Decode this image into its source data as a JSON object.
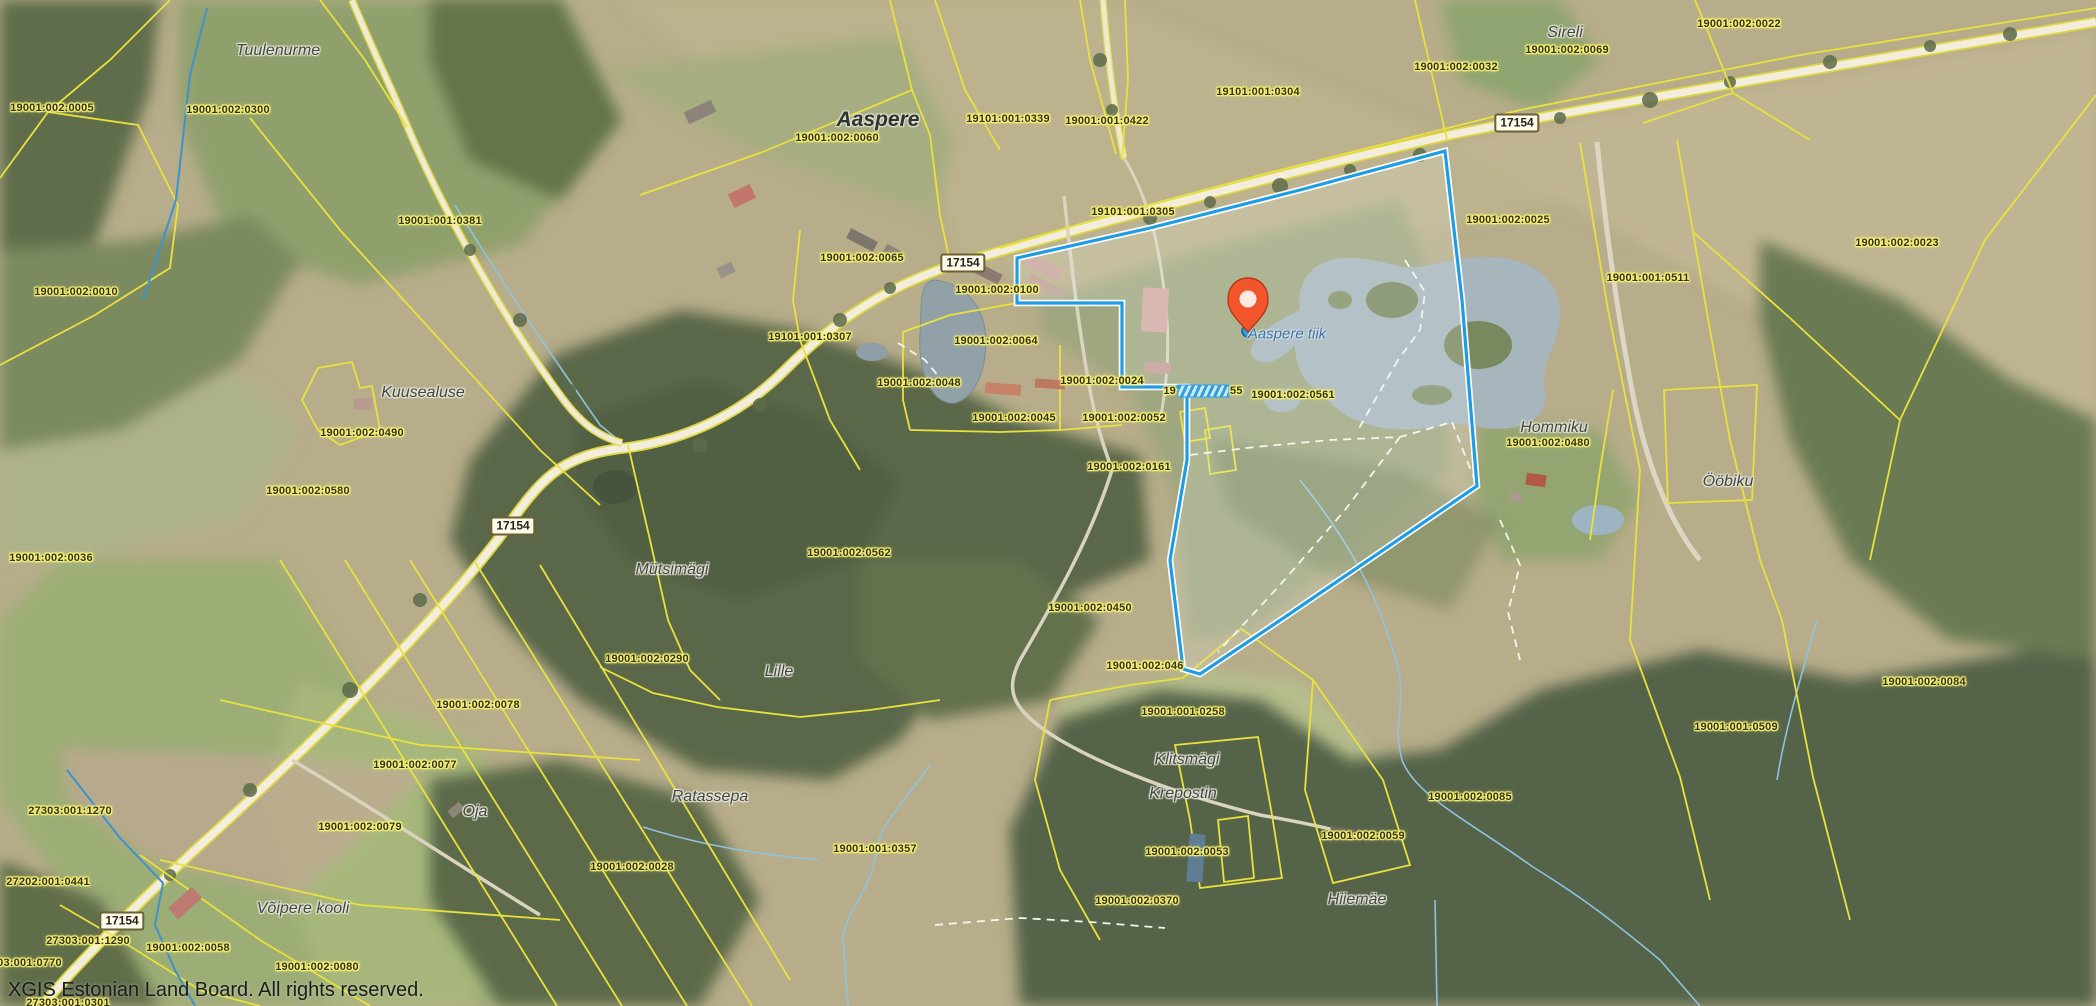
{
  "map": {
    "attribution": "XGIS Estonian Land Board. All rights reserved.",
    "colors": {
      "selection_blue": "#1f9ce2",
      "cadastral_yellow": "#e9e13d",
      "parcel_label_halo": "#f8f376",
      "marker_red": "#f2552c",
      "water_label_blue": "#3f72a6"
    },
    "marker": {
      "x": 1248,
      "y": 330,
      "snap_dot_color": "#2d9fe0"
    },
    "road_badges": [
      {
        "text": "17154",
        "x": 1517,
        "y": 123
      },
      {
        "text": "17154",
        "x": 963,
        "y": 263
      },
      {
        "text": "17154",
        "x": 513,
        "y": 526
      },
      {
        "text": "17154",
        "x": 122,
        "y": 921
      }
    ],
    "labels": [
      {
        "kind": "place",
        "text": "Tuulenurme",
        "x": 278,
        "y": 51
      },
      {
        "kind": "parcel",
        "text": "19001:002:0005",
        "x": 52,
        "y": 108
      },
      {
        "kind": "parcel",
        "text": "19001:002:0300",
        "x": 228,
        "y": 110
      },
      {
        "kind": "parcel",
        "text": "19001:001:0381",
        "x": 440,
        "y": 221
      },
      {
        "kind": "parcel",
        "text": "19001:002:0010",
        "x": 76,
        "y": 292
      },
      {
        "kind": "place",
        "text": "Kuusealuse",
        "x": 423,
        "y": 393
      },
      {
        "kind": "parcel",
        "text": "19001:002:0490",
        "x": 362,
        "y": 433
      },
      {
        "kind": "parcel",
        "text": "19001:002:0580",
        "x": 308,
        "y": 491
      },
      {
        "kind": "parcel",
        "text": "19001:002:0036",
        "x": 51,
        "y": 558
      },
      {
        "kind": "place-major",
        "text": "Aaspere",
        "x": 878,
        "y": 120
      },
      {
        "kind": "parcel",
        "text": "19001:002:0060",
        "x": 837,
        "y": 138
      },
      {
        "kind": "parcel",
        "text": "19101:001:0339",
        "x": 1008,
        "y": 119
      },
      {
        "kind": "parcel",
        "text": "19001:001:0422",
        "x": 1107,
        "y": 121
      },
      {
        "kind": "parcel",
        "text": "19101:001:0305",
        "x": 1133,
        "y": 212
      },
      {
        "kind": "parcel",
        "text": "19101:001:0304",
        "x": 1258,
        "y": 92
      },
      {
        "kind": "place",
        "text": "Sireli",
        "x": 1565,
        "y": 33
      },
      {
        "kind": "parcel",
        "text": "19001:002:0069",
        "x": 1567,
        "y": 50
      },
      {
        "kind": "parcel",
        "text": "19001:002:0032",
        "x": 1456,
        "y": 67
      },
      {
        "kind": "parcel",
        "text": "19001:002:0022",
        "x": 1739,
        "y": 24
      },
      {
        "kind": "parcel",
        "text": "19001:002:0025",
        "x": 1508,
        "y": 220
      },
      {
        "kind": "parcel",
        "text": "19001:001:0511",
        "x": 1648,
        "y": 278
      },
      {
        "kind": "parcel",
        "text": "19001:002:0023",
        "x": 1897,
        "y": 243
      },
      {
        "kind": "parcel",
        "text": "19001:002:0065",
        "x": 862,
        "y": 258
      },
      {
        "kind": "parcel",
        "text": "19001:002:0100",
        "x": 997,
        "y": 290
      },
      {
        "kind": "parcel",
        "text": "19101:001:0307",
        "x": 810,
        "y": 337
      },
      {
        "kind": "parcel",
        "text": "19001:002:0064",
        "x": 996,
        "y": 341
      },
      {
        "kind": "parcel",
        "text": "19001:002:0048",
        "x": 919,
        "y": 383
      },
      {
        "kind": "parcel",
        "text": "19001:002:0024",
        "x": 1102,
        "y": 381
      },
      {
        "kind": "parcel",
        "text": "19001:002:0045",
        "x": 1014,
        "y": 418
      },
      {
        "kind": "parcel",
        "text": "19001:002:0052",
        "x": 1124,
        "y": 418
      },
      {
        "kind": "parcel",
        "text": "19001:002:0561",
        "x": 1293,
        "y": 395
      },
      {
        "kind": "parcel-obscured",
        "prefix": "19",
        "suffix": "55",
        "x": 1203,
        "y": 391
      },
      {
        "kind": "water",
        "text": "Aaspere tiik",
        "x": 1287,
        "y": 334
      },
      {
        "kind": "parcel",
        "text": "19001:002:0161",
        "x": 1129,
        "y": 467
      },
      {
        "kind": "parcel",
        "text": "19001:002:046",
        "x": 1145,
        "y": 666
      },
      {
        "kind": "parcel",
        "text": "19001:002:0450",
        "x": 1090,
        "y": 608
      },
      {
        "kind": "place",
        "text": "Mütsimägi",
        "x": 672,
        "y": 570
      },
      {
        "kind": "parcel",
        "text": "19001:002:0562",
        "x": 849,
        "y": 553
      },
      {
        "kind": "parcel",
        "text": "19001:002:0290",
        "x": 647,
        "y": 659
      },
      {
        "kind": "place",
        "text": "Lille",
        "x": 779,
        "y": 672
      },
      {
        "kind": "parcel",
        "text": "19001:002:0078",
        "x": 478,
        "y": 705
      },
      {
        "kind": "parcel",
        "text": "19001:002:0077",
        "x": 415,
        "y": 765
      },
      {
        "kind": "place",
        "text": "Oja",
        "x": 475,
        "y": 812
      },
      {
        "kind": "parcel",
        "text": "19001:002:0079",
        "x": 360,
        "y": 827
      },
      {
        "kind": "place",
        "text": "Ratassepa",
        "x": 710,
        "y": 797
      },
      {
        "kind": "parcel",
        "text": "19001:002:0028",
        "x": 632,
        "y": 867
      },
      {
        "kind": "parcel",
        "text": "19001:001:0357",
        "x": 875,
        "y": 849
      },
      {
        "kind": "parcel",
        "text": "27303:001:1270",
        "x": 70,
        "y": 811
      },
      {
        "kind": "parcel",
        "text": "27202:001:0441",
        "x": 48,
        "y": 882
      },
      {
        "kind": "parcel",
        "text": "27303:001:1290",
        "x": 88,
        "y": 941
      },
      {
        "kind": "parcel",
        "text": "27303:001:0770",
        "x": 20,
        "y": 963
      },
      {
        "kind": "parcel",
        "text": "19001:002:0058",
        "x": 188,
        "y": 948
      },
      {
        "kind": "place",
        "text": "Võipere kooli",
        "x": 303,
        "y": 909
      },
      {
        "kind": "parcel",
        "text": "19001:002:0080",
        "x": 317,
        "y": 967
      },
      {
        "kind": "parcel",
        "text": "27303:001:0301",
        "x": 68,
        "y": 1003
      },
      {
        "kind": "parcel",
        "text": "19001:001:0258",
        "x": 1183,
        "y": 712
      },
      {
        "kind": "place",
        "text": "Klitsmägi",
        "x": 1187,
        "y": 760
      },
      {
        "kind": "place",
        "text": "Krepostin",
        "x": 1183,
        "y": 794
      },
      {
        "kind": "parcel",
        "text": "19001:002:0053",
        "x": 1187,
        "y": 852
      },
      {
        "kind": "parcel",
        "text": "19001:002:0370",
        "x": 1137,
        "y": 901
      },
      {
        "kind": "parcel",
        "text": "19001:002:0059",
        "x": 1363,
        "y": 836
      },
      {
        "kind": "place",
        "text": "Hiiemäe",
        "x": 1357,
        "y": 900
      },
      {
        "kind": "parcel",
        "text": "19001:002:0085",
        "x": 1470,
        "y": 797
      },
      {
        "kind": "place",
        "text": "Hommiku",
        "x": 1554,
        "y": 428
      },
      {
        "kind": "parcel",
        "text": "19001:002:0480",
        "x": 1548,
        "y": 443
      },
      {
        "kind": "place",
        "text": "Ööbiku",
        "x": 1728,
        "y": 482
      },
      {
        "kind": "parcel",
        "text": "19001:002:0084",
        "x": 1924,
        "y": 682
      },
      {
        "kind": "parcel",
        "text": "19001:001:0509",
        "x": 1736,
        "y": 727
      }
    ]
  }
}
